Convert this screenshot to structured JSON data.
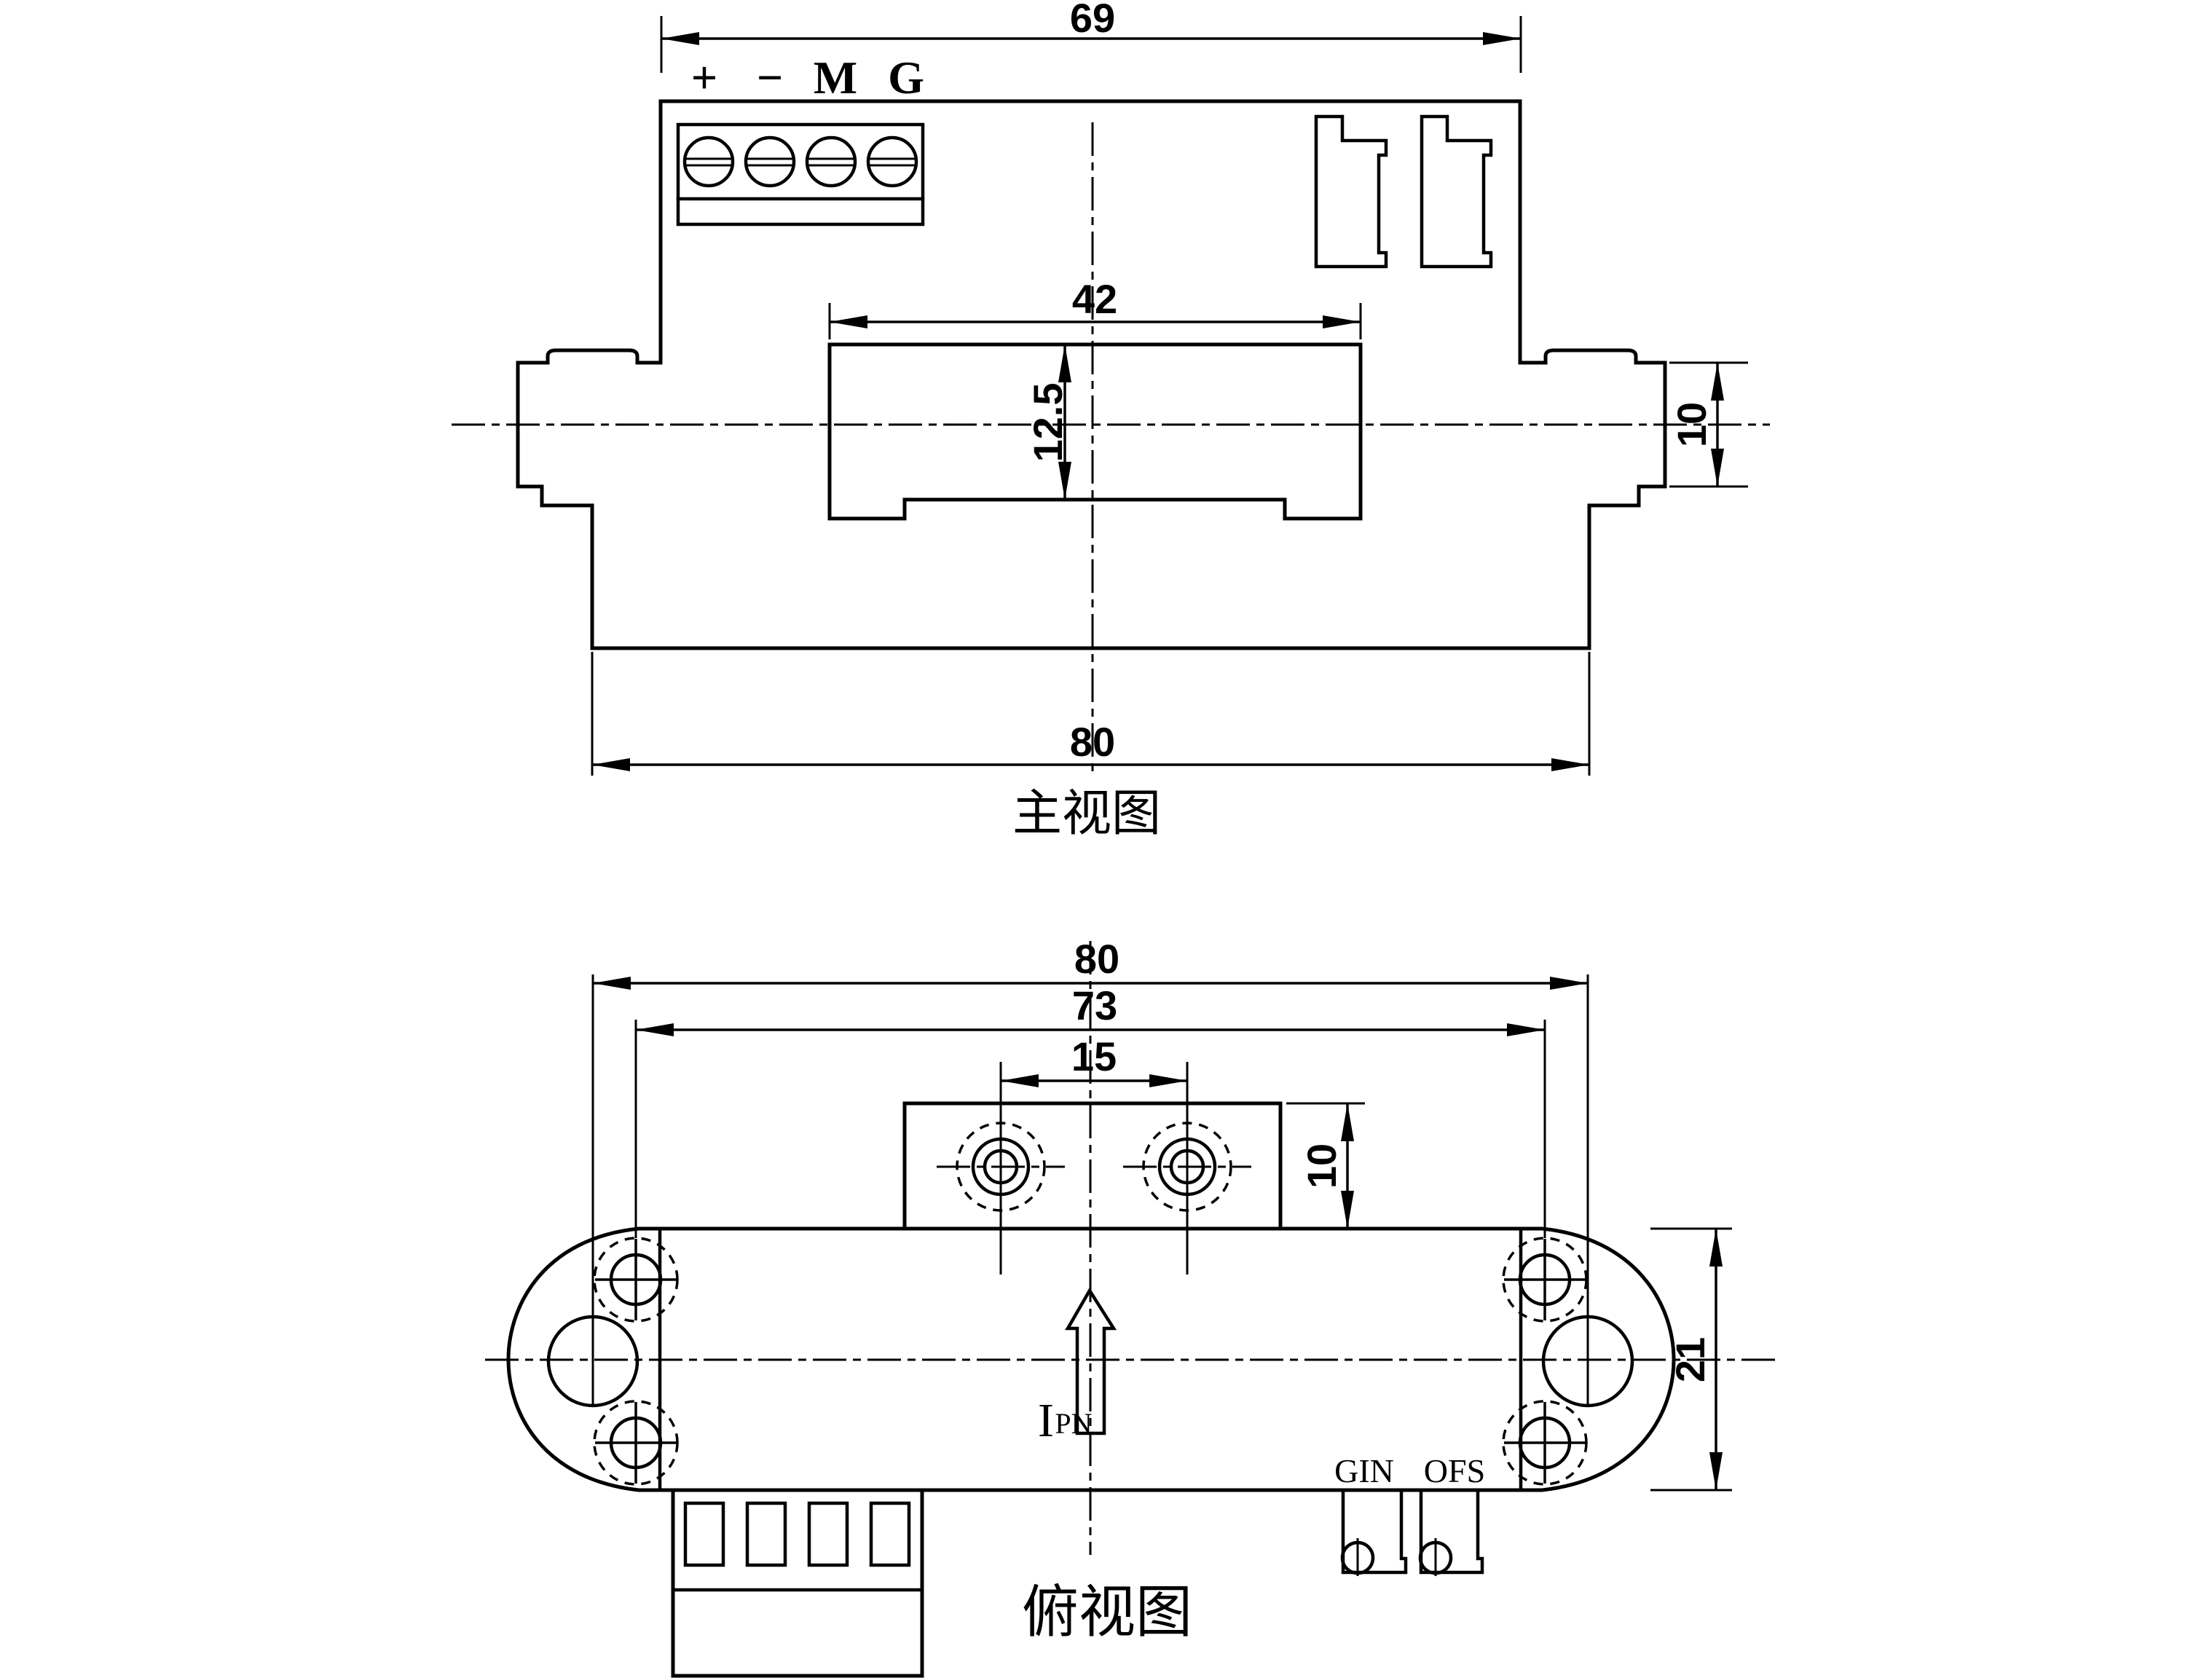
{
  "drawing": {
    "background_color": "#ffffff",
    "line_color": "#000000"
  },
  "front_view": {
    "title": "主视图",
    "terminals": [
      "+",
      "−",
      "M",
      "G"
    ],
    "dims": {
      "body_width": "69",
      "window_width": "42",
      "window_height": "12.5",
      "flange_height": "10",
      "base_width": "80"
    }
  },
  "top_view": {
    "title": "俯视图",
    "dims": {
      "overall_width": "80",
      "mount_hole_span": "73",
      "clamp_hole_span": "15",
      "clamp_depth": "10",
      "body_depth": "21"
    },
    "pot_labels": {
      "gain": "GIN",
      "offset": "OFS"
    },
    "current_label": {
      "main": "I",
      "sub": "PN"
    }
  }
}
